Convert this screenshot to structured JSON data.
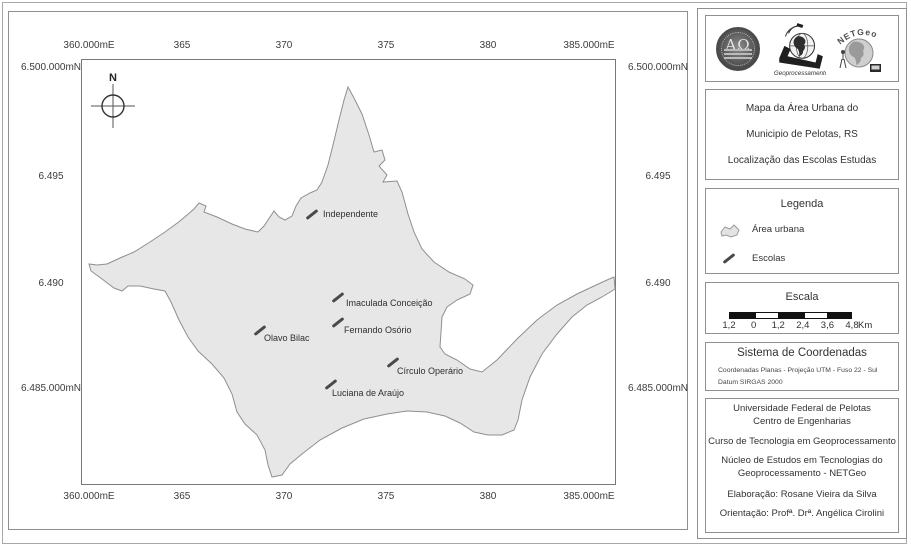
{
  "map": {
    "north_indicator": "N",
    "x_labels": [
      "360.000mE",
      "365",
      "370",
      "375",
      "380",
      "385.000mE"
    ],
    "y_labels": [
      "6.500.000mN",
      "6.495",
      "6.490",
      "6.485.000mN"
    ],
    "schools": [
      {
        "name": "Independente",
        "marker": [
          230,
          155
        ],
        "label": [
          241,
          155
        ]
      },
      {
        "name": "Imaculada Conceição",
        "marker": [
          256,
          238
        ],
        "label": [
          264,
          244
        ]
      },
      {
        "name": "Fernando Osório",
        "marker": [
          256,
          263
        ],
        "label": [
          262,
          271
        ]
      },
      {
        "name": "Olavo Bilac",
        "marker": [
          178,
          271
        ],
        "label": [
          182,
          279
        ]
      },
      {
        "name": "Círculo Operário",
        "marker": [
          311,
          303
        ],
        "label": [
          315,
          312
        ]
      },
      {
        "name": "Luciana de Araújo",
        "marker": [
          249,
          325
        ],
        "label": [
          250,
          334
        ]
      }
    ],
    "colors": {
      "urban_fill": "#e7e7e7",
      "urban_stroke": "#8f8f8f",
      "school_marker": "#4a4a4a"
    },
    "urban_area_outline": [
      [
        266,
        27
      ],
      [
        272,
        38
      ],
      [
        280,
        54
      ],
      [
        287,
        75
      ],
      [
        292,
        92
      ],
      [
        300,
        90
      ],
      [
        303,
        100
      ],
      [
        297,
        106
      ],
      [
        305,
        115
      ],
      [
        301,
        122
      ],
      [
        315,
        121
      ],
      [
        320,
        132
      ],
      [
        326,
        154
      ],
      [
        332,
        172
      ],
      [
        340,
        189
      ],
      [
        352,
        202
      ],
      [
        367,
        212
      ],
      [
        383,
        219
      ],
      [
        391,
        225
      ],
      [
        388,
        234
      ],
      [
        375,
        240
      ],
      [
        365,
        247
      ],
      [
        360,
        257
      ],
      [
        359,
        272
      ],
      [
        358,
        287
      ],
      [
        363,
        294
      ],
      [
        375,
        300
      ],
      [
        388,
        309
      ],
      [
        400,
        312
      ],
      [
        415,
        300
      ],
      [
        435,
        279
      ],
      [
        455,
        260
      ],
      [
        475,
        245
      ],
      [
        495,
        234
      ],
      [
        512,
        226
      ],
      [
        525,
        220
      ],
      [
        532,
        217
      ],
      [
        533,
        229
      ],
      [
        520,
        237
      ],
      [
        505,
        245
      ],
      [
        490,
        257
      ],
      [
        475,
        274
      ],
      [
        460,
        294
      ],
      [
        448,
        317
      ],
      [
        440,
        340
      ],
      [
        436,
        360
      ],
      [
        432,
        370
      ],
      [
        420,
        375
      ],
      [
        406,
        375
      ],
      [
        392,
        372
      ],
      [
        378,
        363
      ],
      [
        363,
        356
      ],
      [
        345,
        352
      ],
      [
        325,
        351
      ],
      [
        305,
        354
      ],
      [
        282,
        359
      ],
      [
        260,
        368
      ],
      [
        238,
        380
      ],
      [
        220,
        394
      ],
      [
        208,
        404
      ],
      [
        200,
        415
      ],
      [
        190,
        417
      ],
      [
        186,
        405
      ],
      [
        183,
        390
      ],
      [
        175,
        375
      ],
      [
        163,
        364
      ],
      [
        155,
        352
      ],
      [
        150,
        334
      ],
      [
        142,
        318
      ],
      [
        130,
        304
      ],
      [
        116,
        291
      ],
      [
        106,
        277
      ],
      [
        97,
        260
      ],
      [
        89,
        242
      ],
      [
        83,
        231
      ],
      [
        72,
        229
      ],
      [
        58,
        226
      ],
      [
        46,
        226
      ],
      [
        40,
        231
      ],
      [
        32,
        228
      ],
      [
        20,
        219
      ],
      [
        9,
        211
      ],
      [
        7,
        204
      ],
      [
        15,
        205
      ],
      [
        25,
        204
      ],
      [
        38,
        198
      ],
      [
        52,
        192
      ],
      [
        68,
        182
      ],
      [
        83,
        172
      ],
      [
        98,
        161
      ],
      [
        112,
        149
      ],
      [
        117,
        143
      ],
      [
        124,
        146
      ],
      [
        122,
        152
      ],
      [
        135,
        157
      ],
      [
        150,
        164
      ],
      [
        163,
        169
      ],
      [
        176,
        172
      ],
      [
        182,
        166
      ],
      [
        188,
        157
      ],
      [
        192,
        151
      ],
      [
        197,
        157
      ],
      [
        203,
        160
      ],
      [
        210,
        156
      ],
      [
        214,
        146
      ],
      [
        219,
        138
      ],
      [
        228,
        133
      ],
      [
        235,
        130
      ],
      [
        240,
        122
      ],
      [
        246,
        105
      ],
      [
        251,
        85
      ],
      [
        257,
        60
      ],
      [
        262,
        40
      ]
    ]
  },
  "sidebar": {
    "logos": [
      {
        "name": "ufpel-seal",
        "text": "ΑΩ"
      },
      {
        "name": "geoprocessamento",
        "label": "Geoprocessamento"
      },
      {
        "name": "netgeo",
        "label": "NETGeo"
      }
    ],
    "title": {
      "line1": "Mapa da Área Urbana do",
      "line2": "Municipio de Pelotas, RS",
      "line3": "Localização das Escolas Estudas"
    },
    "legend": {
      "heading": "Legenda",
      "items": [
        {
          "label": "Área urbana"
        },
        {
          "label": "Escolas"
        }
      ]
    },
    "scale": {
      "heading": "Escala",
      "ticks": [
        "1,2",
        "0",
        "1,2",
        "2,4",
        "3,6",
        "4,8"
      ],
      "unit": "Km"
    },
    "coordinate_system": {
      "heading": "Sistema de Coordenadas",
      "line1": "Coordenadas Planas - Projeção UTM - Fuso 22 - Sul",
      "line2": "Datum SIRGAS 2000"
    },
    "credits": {
      "groups": [
        [
          "Universidade Federal de Pelotas",
          "Centro de Engenharias"
        ],
        [
          "Curso de Tecnologia em Geoprocessamento"
        ],
        [
          "Núcleo de Estudos em Tecnologias do",
          "Geoprocessamento - NETGeo"
        ],
        [
          "Elaboração: Rosane Vieira da Silva"
        ],
        [
          "Orientação: Profª. Drª. Angélica Cirolini"
        ]
      ]
    }
  }
}
